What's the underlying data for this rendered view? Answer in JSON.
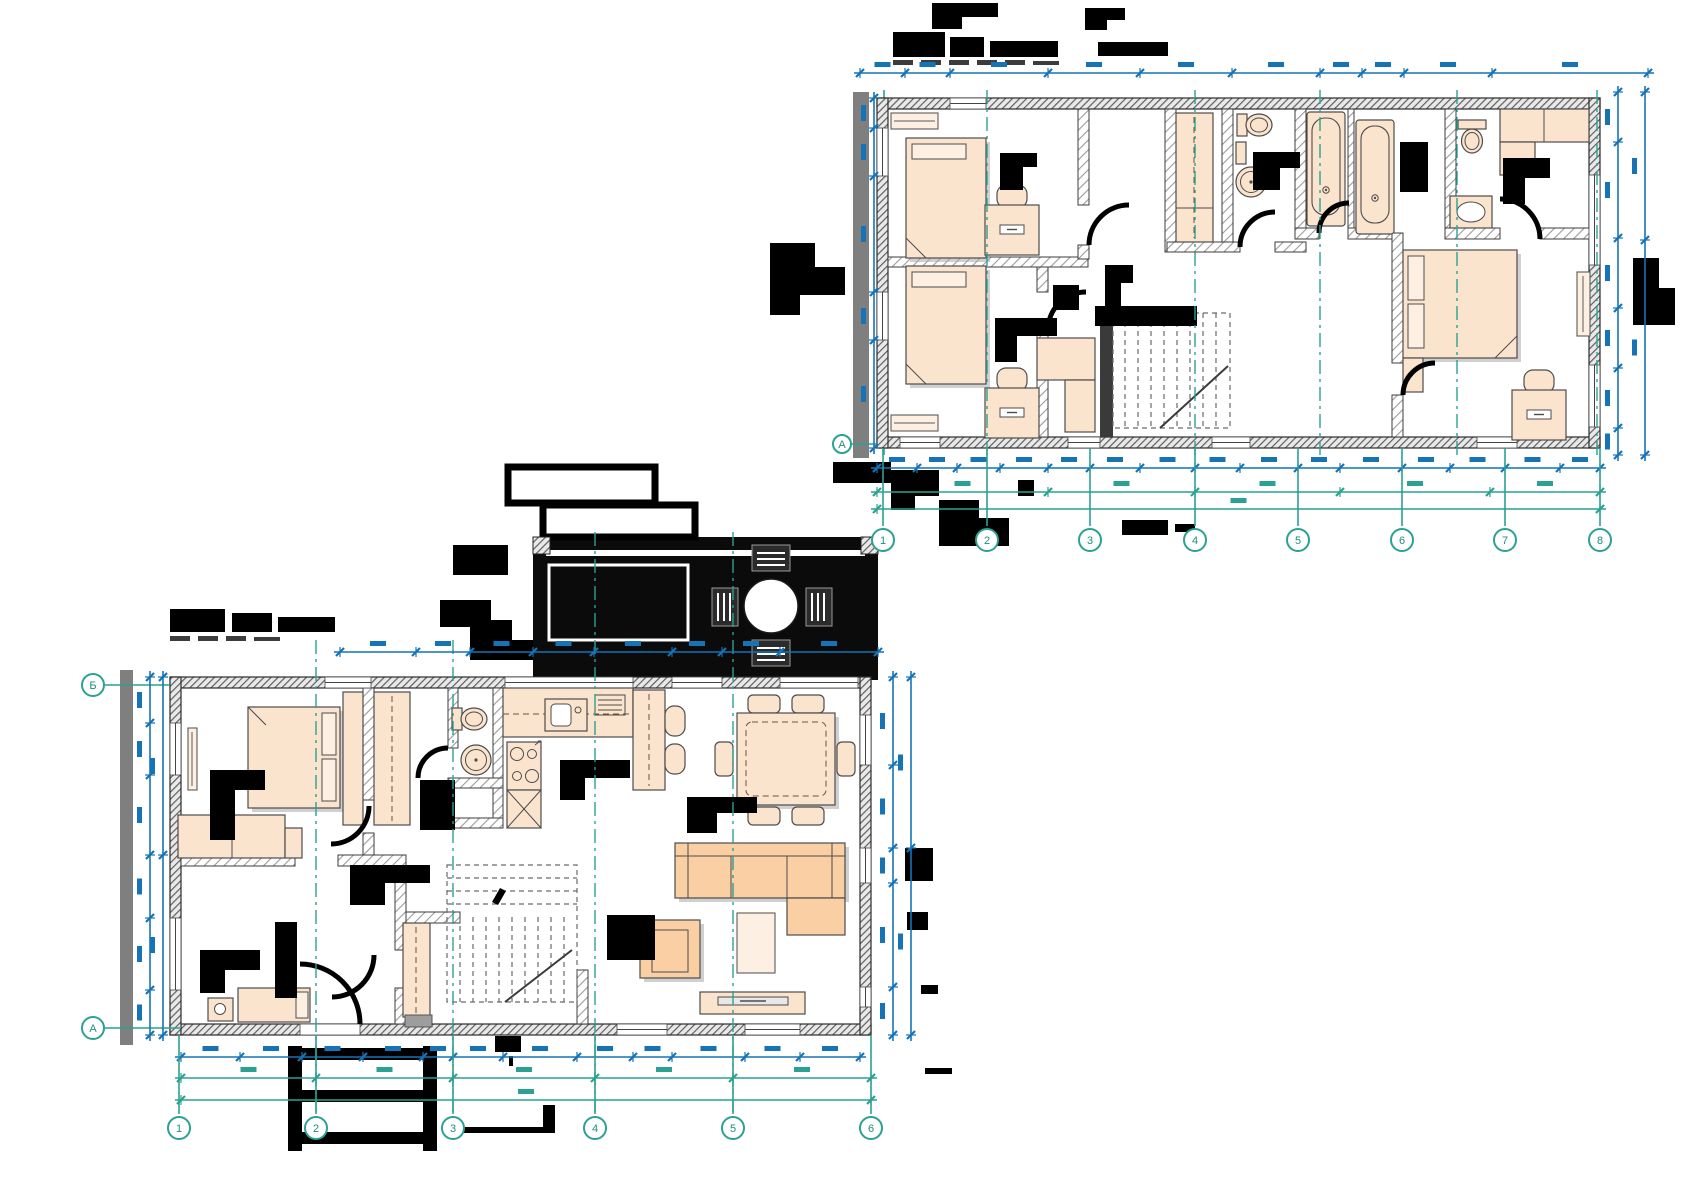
{
  "note": "CAD floor-plan screenshot; all title blocks, room labels and dimension values are rasterized illegible black/blue blobs in the source image",
  "palette": {
    "background": "#ffffff",
    "dimension_blue": "#1573b6",
    "axis_teal": "#2aa191",
    "wall_dark": "#2e2e2e",
    "wall_gray": "#7f7f7f",
    "furniture_fill": "#fbe4cd",
    "furniture_fill_strong": "#f9cfa3",
    "furniture_fill_light": "#fdf0e2",
    "annotation_black": "#000000",
    "deck_black": "#0b0b0b"
  },
  "floor2": {
    "title_legible": false,
    "grid_columns": [
      "1",
      "2",
      "3",
      "4",
      "5",
      "6",
      "7",
      "8"
    ],
    "grid_row": "А",
    "rooms": [
      "bedroom-1",
      "bedroom-2",
      "hallway",
      "wc",
      "bathroom-1",
      "bathroom-2",
      "master-wc",
      "master-bedroom",
      "staircase"
    ],
    "furniture": [
      "single-bed",
      "single-bed",
      "desk-with-chair",
      "desk-with-chair",
      "tall-wardrobe",
      "toilet",
      "round-washbasin",
      "bathtub",
      "bathtub",
      "toilet",
      "counter-washbasin",
      "double-bed",
      "nightstand",
      "desk-with-chair",
      "wardrobe-row",
      "mirror",
      "hall-cabinet"
    ]
  },
  "floor1": {
    "title_legible": false,
    "grid_columns": [
      "1",
      "2",
      "3",
      "4",
      "5",
      "6"
    ],
    "grid_rows": [
      "Б",
      "А"
    ],
    "rooms": [
      "bedroom",
      "hallway",
      "wc",
      "kitchen",
      "dining-area",
      "living-room",
      "entry",
      "back-room",
      "staircase",
      "terrace"
    ],
    "furniture": [
      "double-bed",
      "wardrobe",
      "hall-wardrobe",
      "dresser",
      "mirror",
      "single-bed",
      "side-table",
      "toilet",
      "round-washbasin",
      "kitchen-counter",
      "kitchen-sink",
      "cooktop",
      "oven-cabinet",
      "kitchen-island",
      "bar-stool",
      "bar-stool",
      "dining-table",
      "dining-chairs",
      "corner-sofa",
      "armchair",
      "coffee-table",
      "tv-console",
      "entry-closet",
      "round-terrace-table",
      "terrace-chairs",
      "planter-box"
    ]
  }
}
